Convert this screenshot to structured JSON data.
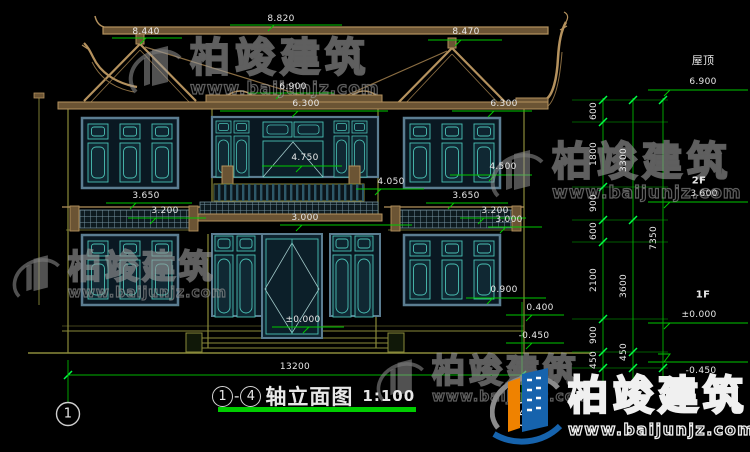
{
  "title": {
    "axis_from": "1",
    "dash": "-",
    "axis_to": "4",
    "text": "轴立面图",
    "scale": "1:100"
  },
  "watermark": {
    "brand": "柏竣建筑",
    "url": "www.baijunjz.com"
  },
  "logo": {
    "brand": "柏竣建筑",
    "url": "www.baijunjz.com"
  },
  "axis_bubbles": {
    "left": "1",
    "right": "4"
  },
  "levels": {
    "roof_label": "屋顶",
    "roof_value": "6.900",
    "floor2_label": "2F",
    "floor2_value": "3.600",
    "floor1_label": "1F",
    "floor1_value": "±0.000",
    "grade_value": "-0.450"
  },
  "dimension_chains": {
    "inner": [
      "600",
      "1800",
      "900",
      "600",
      "2100",
      "900",
      "450"
    ],
    "middle": [
      "3300",
      "3600",
      "450"
    ],
    "outer": [
      "7350"
    ],
    "total_width": "13200"
  },
  "annotations": [
    {
      "t": "8.820",
      "x": 281,
      "y": 19
    },
    {
      "t": "8.440",
      "x": 146,
      "y": 32
    },
    {
      "t": "8.470",
      "x": 466,
      "y": 32
    },
    {
      "t": "6.900",
      "x": 293,
      "y": 87
    },
    {
      "t": "6.300",
      "x": 306,
      "y": 104
    },
    {
      "t": "6.300",
      "x": 504,
      "y": 104
    },
    {
      "t": "4.750",
      "x": 305,
      "y": 158
    },
    {
      "t": "4.500",
      "x": 503,
      "y": 167
    },
    {
      "t": "4.050",
      "x": 391,
      "y": 182
    },
    {
      "t": "3.650",
      "x": 146,
      "y": 196
    },
    {
      "t": "3.200",
      "x": 165,
      "y": 211
    },
    {
      "t": "3.650",
      "x": 466,
      "y": 196
    },
    {
      "t": "3.200",
      "x": 495,
      "y": 211
    },
    {
      "t": "3.000",
      "x": 305,
      "y": 218
    },
    {
      "t": "3.000",
      "x": 509,
      "y": 220
    },
    {
      "t": "0.900",
      "x": 504,
      "y": 290
    },
    {
      "t": "±0.000",
      "x": 303,
      "y": 320
    },
    {
      "t": "0.400",
      "x": 540,
      "y": 308
    },
    {
      "t": "-0.450",
      "x": 534,
      "y": 336
    },
    {
      "t": "13200",
      "x": 295,
      "y": 367
    },
    {
      "t": "屋顶",
      "x": 703,
      "y": 60,
      "cls": "cjk"
    },
    {
      "t": "6.900",
      "x": 703,
      "y": 82
    },
    {
      "t": "2F",
      "x": 699,
      "y": 181,
      "cls": "lvl"
    },
    {
      "t": "3.600",
      "x": 704,
      "y": 194
    },
    {
      "t": "1F",
      "x": 703,
      "y": 295,
      "cls": "lvl"
    },
    {
      "t": "±0.000",
      "x": 699,
      "y": 315
    },
    {
      "t": "-0.450",
      "x": 701,
      "y": 371
    },
    {
      "t": "600",
      "x": 594,
      "y": 111,
      "cls": "rot"
    },
    {
      "t": "1800",
      "x": 594,
      "y": 154,
      "cls": "rot"
    },
    {
      "t": "900",
      "x": 594,
      "y": 203,
      "cls": "rot"
    },
    {
      "t": "600",
      "x": 594,
      "y": 231,
      "cls": "rot"
    },
    {
      "t": "2100",
      "x": 594,
      "y": 280,
      "cls": "rot"
    },
    {
      "t": "900",
      "x": 594,
      "y": 335,
      "cls": "rot"
    },
    {
      "t": "450",
      "x": 594,
      "y": 360,
      "cls": "rot"
    },
    {
      "t": "3300",
      "x": 624,
      "y": 160,
      "cls": "rot"
    },
    {
      "t": "3600",
      "x": 624,
      "y": 286,
      "cls": "rot"
    },
    {
      "t": "450",
      "x": 624,
      "y": 352,
      "cls": "rot"
    },
    {
      "t": "7350",
      "x": 654,
      "y": 238,
      "cls": "rot"
    },
    {
      "t": "1",
      "x": 68,
      "y": 414,
      "cls": "axis"
    },
    {
      "t": "4",
      "x": 523,
      "y": 414,
      "cls": "axis"
    }
  ]
}
